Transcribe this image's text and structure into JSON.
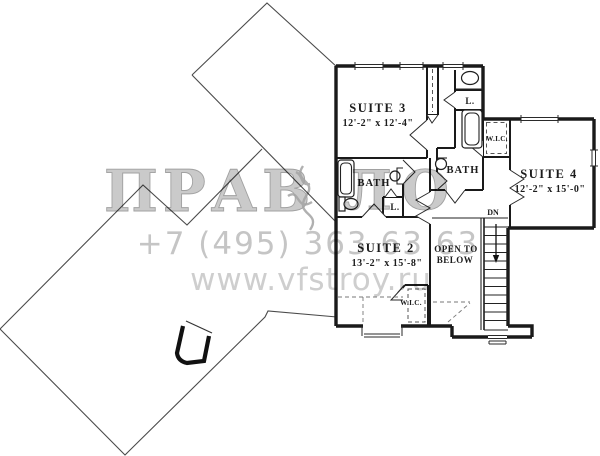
{
  "plan": {
    "ink": "#1a1a1a",
    "rooms": {
      "suite3": {
        "name": "SUITE 3",
        "dims": "12'-2\" x 12'-4\""
      },
      "suite4": {
        "name": "SUITE 4",
        "dims": "12'-2\" x 15'-0\""
      },
      "suite2": {
        "name": "SUITE 2",
        "dims": "13'-2\" x 15'-8\""
      },
      "bath_left": {
        "name": "BATH"
      },
      "bath_middle": {
        "name": "BATH"
      },
      "wic_top": {
        "name": "W.I.C."
      },
      "wic_bottom": {
        "name": "W.I.C."
      },
      "linen_top": {
        "name": "L."
      },
      "linen_left": {
        "name": "L."
      },
      "open_to_below_line1": "OPEN TO",
      "open_to_below_line2": "BELOW",
      "stairs_down": "DN"
    }
  },
  "watermark": {
    "brand_left": "ПРАВ",
    "brand_right": "ЛО",
    "phone": "+7 (495) 363 63 63",
    "url": "www.vfstroy.ru",
    "text_color": "#c3c3c3"
  }
}
